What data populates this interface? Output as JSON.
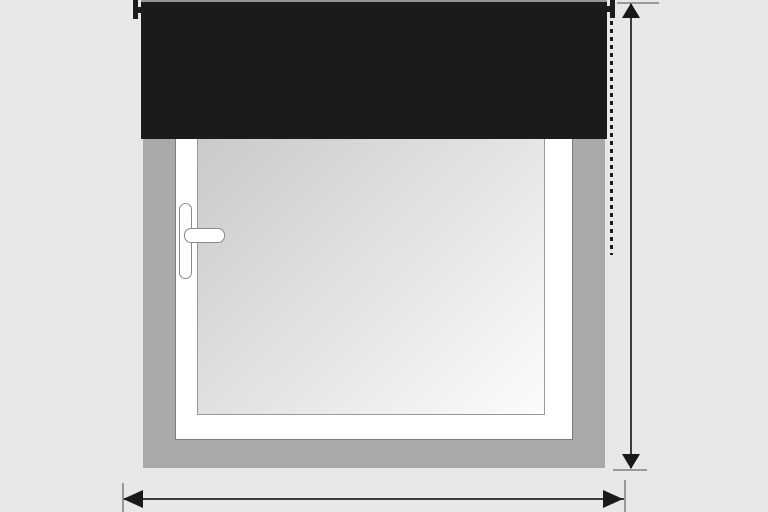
{
  "diagram": {
    "type": "window-roller-blind-measurement-guide",
    "colors": {
      "background": "#e8e8e8",
      "wall": "#a9a9a9",
      "blind": "#1b1b1b",
      "blind_top_highlight": "#969696",
      "bracket": "#1b1b1b",
      "frame_fill": "#ffffff",
      "frame_border": "#7d7d7d",
      "glass_border": "#9a9a9a",
      "glass_gradient_start": "#c6c6c6",
      "glass_gradient_end": "#fcfcfc",
      "handle_fill": "#ffffff",
      "handle_border": "#8a8a8a",
      "dashed_guide": "#1b1b1b",
      "measure_shaft": "#3c3c3c",
      "measure_arrowhead": "#1a1a1a",
      "measure_tick": "#999999"
    },
    "icons": [
      "arrow-up-icon",
      "arrow-down-icon",
      "arrow-left-icon",
      "arrow-right-icon"
    ],
    "measurements": {
      "vertical": "height-extent-right-side",
      "horizontal": "width-extent-bottom"
    }
  }
}
